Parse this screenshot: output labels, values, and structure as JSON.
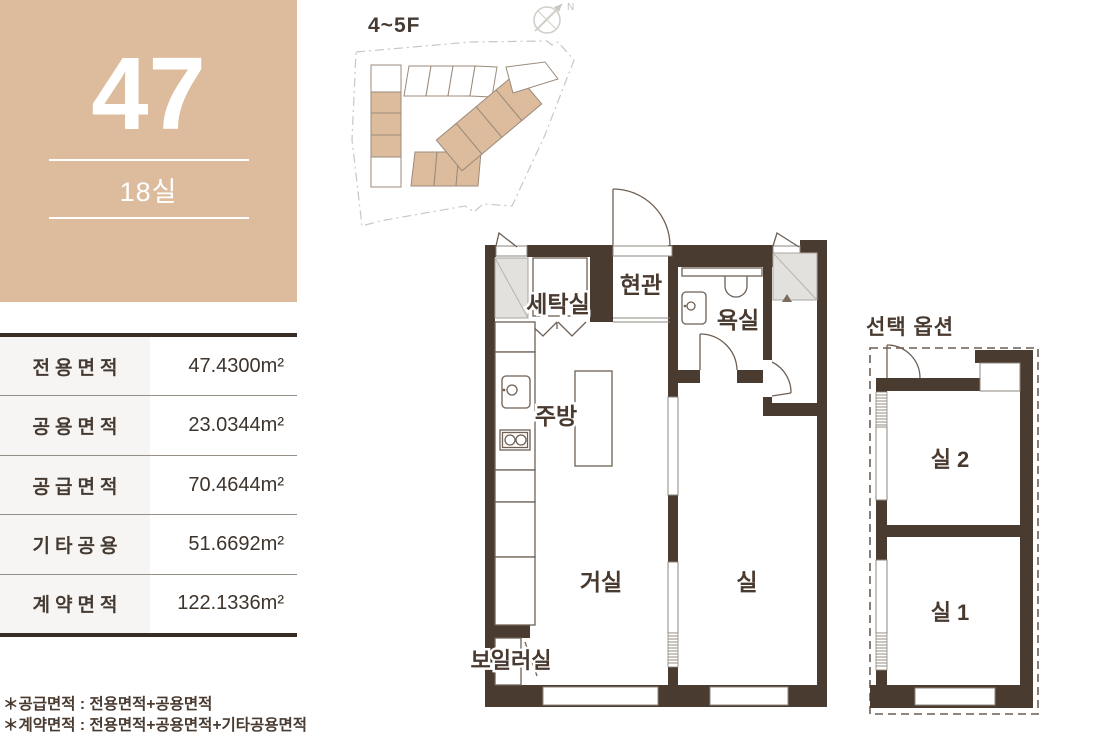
{
  "unit": {
    "number": "47",
    "rooms_label": "18실"
  },
  "site_plan": {
    "floor_label": "4~5F",
    "compass_label": "N"
  },
  "area_table": {
    "rows": [
      {
        "label": "전용면적",
        "value": "47.4300m²"
      },
      {
        "label": "공용면적",
        "value": "23.0344m²"
      },
      {
        "label": "공급면적",
        "value": "70.4644m²"
      },
      {
        "label": "기타공용",
        "value": "51.6692m²"
      },
      {
        "label": "계약면적",
        "value": "122.1336m²"
      }
    ]
  },
  "floor_plan": {
    "labels": {
      "laundry": "세탁실",
      "entrance": "현관",
      "bathroom": "욕실",
      "kitchen": "주방",
      "living_room": "거실",
      "room": "실",
      "boiler_room": "보일러실"
    }
  },
  "option_plan": {
    "title": "선택 옵션",
    "room2_label": "실 2",
    "room1_label": "실 1"
  },
  "footnotes": {
    "supply": "＊공급면적 : 전용면적+공용면적",
    "contract": "＊계약면적 : 전용면적+공용면적+기타공용면적"
  },
  "colors": {
    "accent_tan": "#dcbc9d",
    "wall_brown": "#4a3b31"
  }
}
